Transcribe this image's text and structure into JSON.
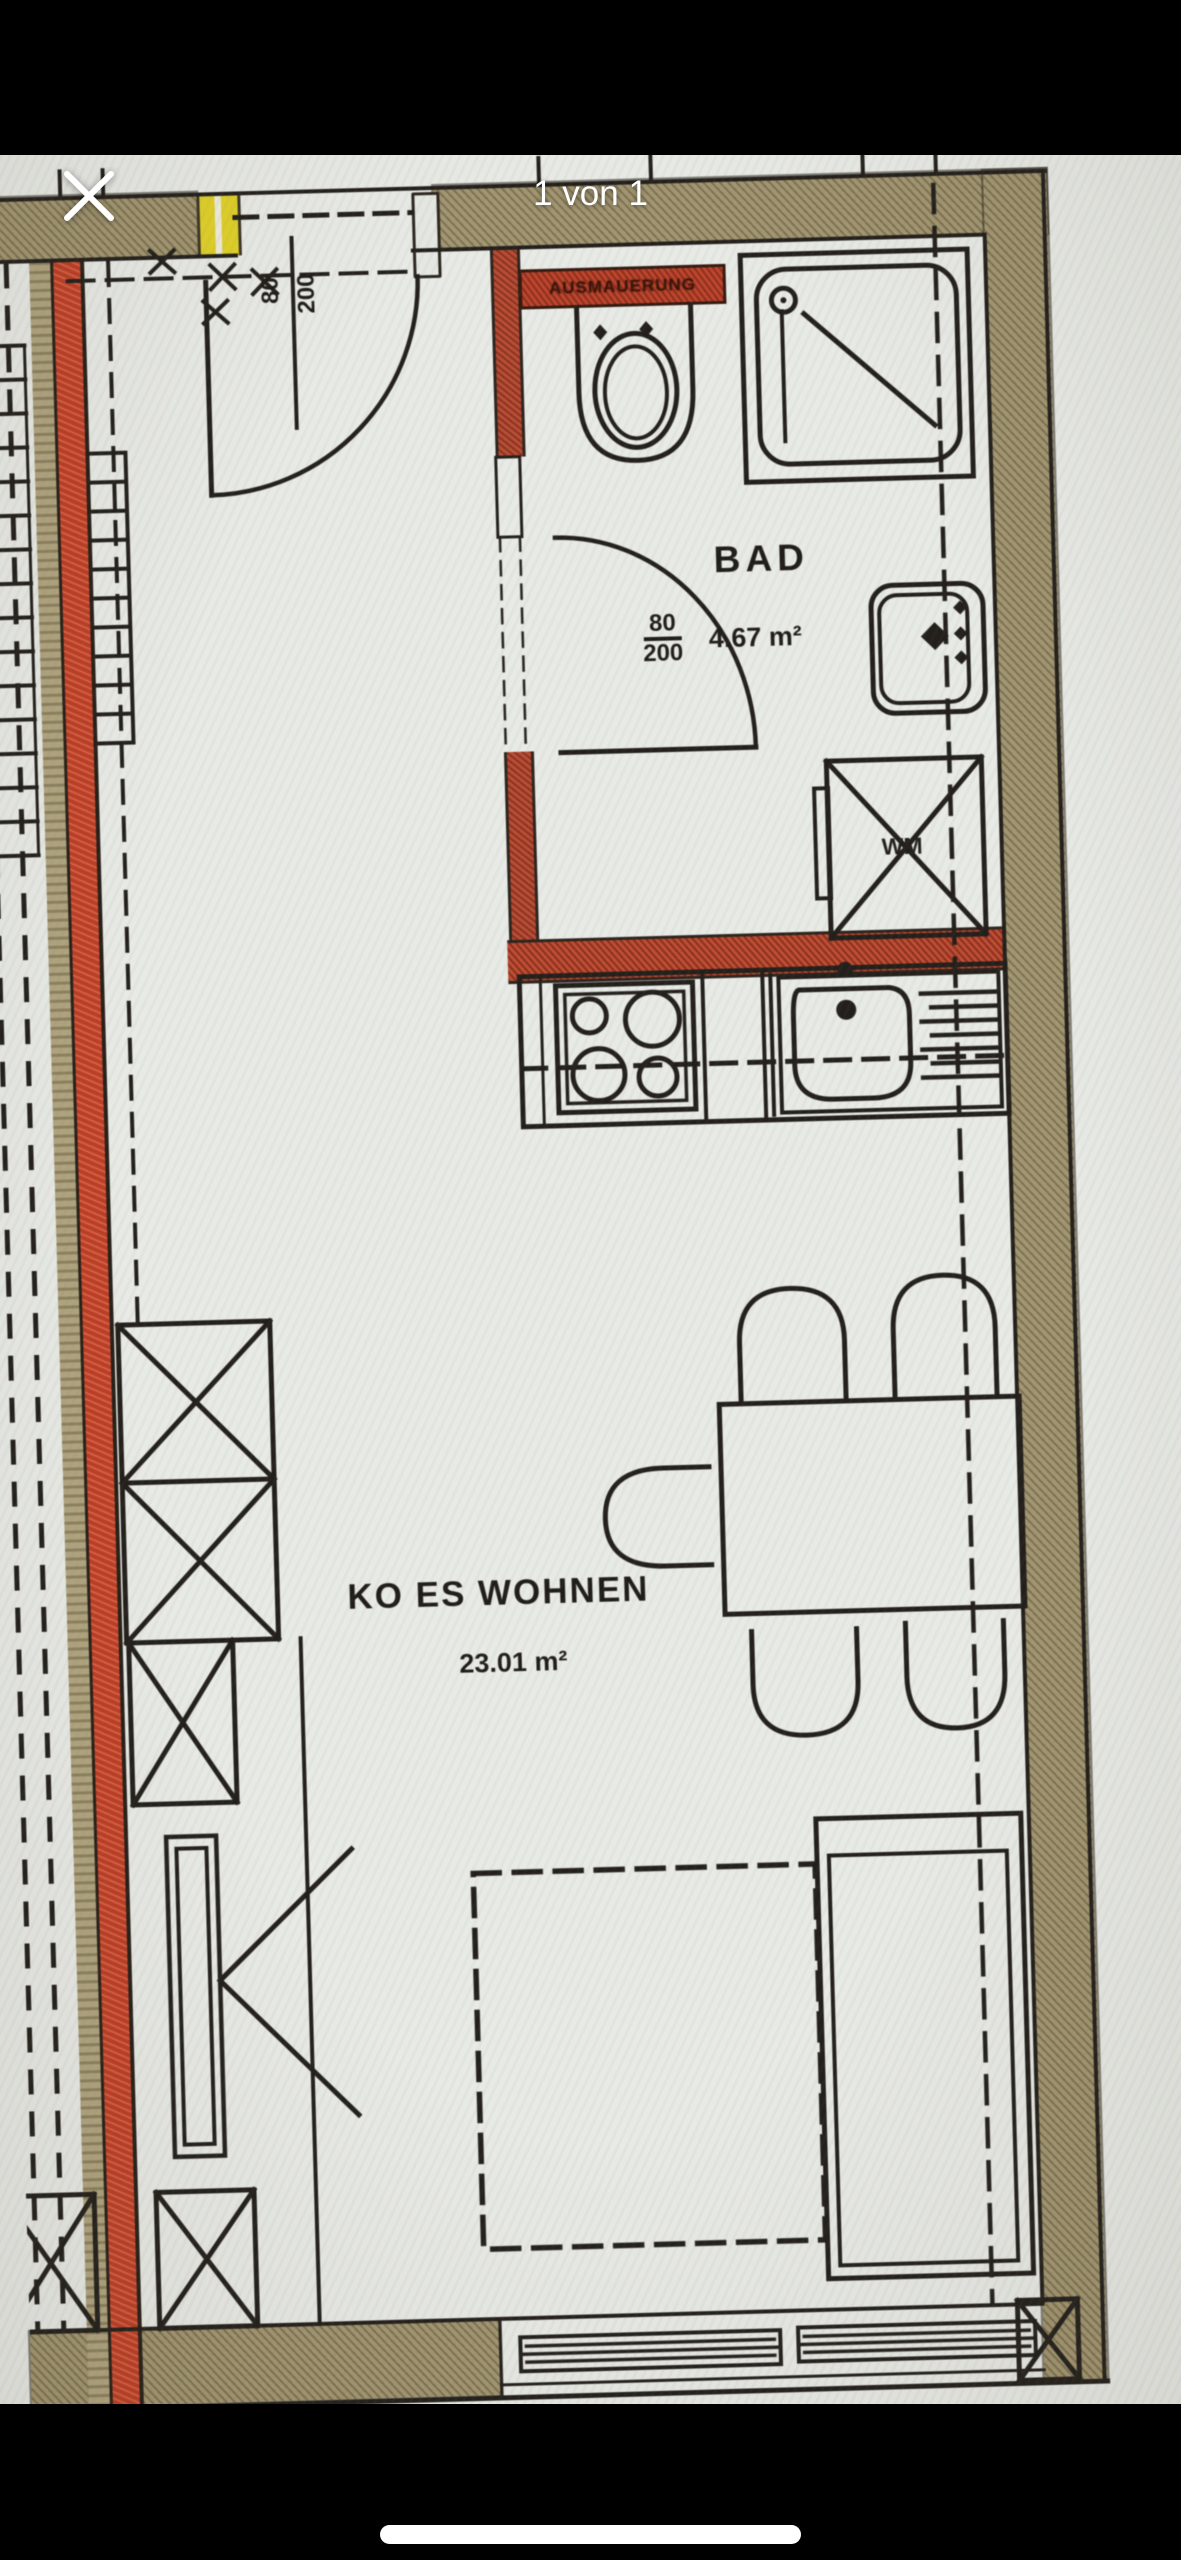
{
  "viewer": {
    "counter": "1 von 1",
    "close_icon": "close-x",
    "background": "#000000"
  },
  "plan": {
    "rooms": [
      {
        "name": "BAD",
        "area": "4.67 m²",
        "door_width": "80",
        "door_height": "200"
      },
      {
        "name": "KO ES WOHNEN",
        "area": "23.01 m²"
      }
    ],
    "entry_door": {
      "width": "80",
      "height": "200"
    },
    "labels": {
      "washing_machine": "WM",
      "wall_infill": "AUSMAUERUNG"
    },
    "colors": {
      "paper": "#e8eae6",
      "wall_tan": "#a59871",
      "wall_red": "#c84a2e",
      "marker_yellow": "#e3d31f",
      "line": "#201d19"
    }
  }
}
